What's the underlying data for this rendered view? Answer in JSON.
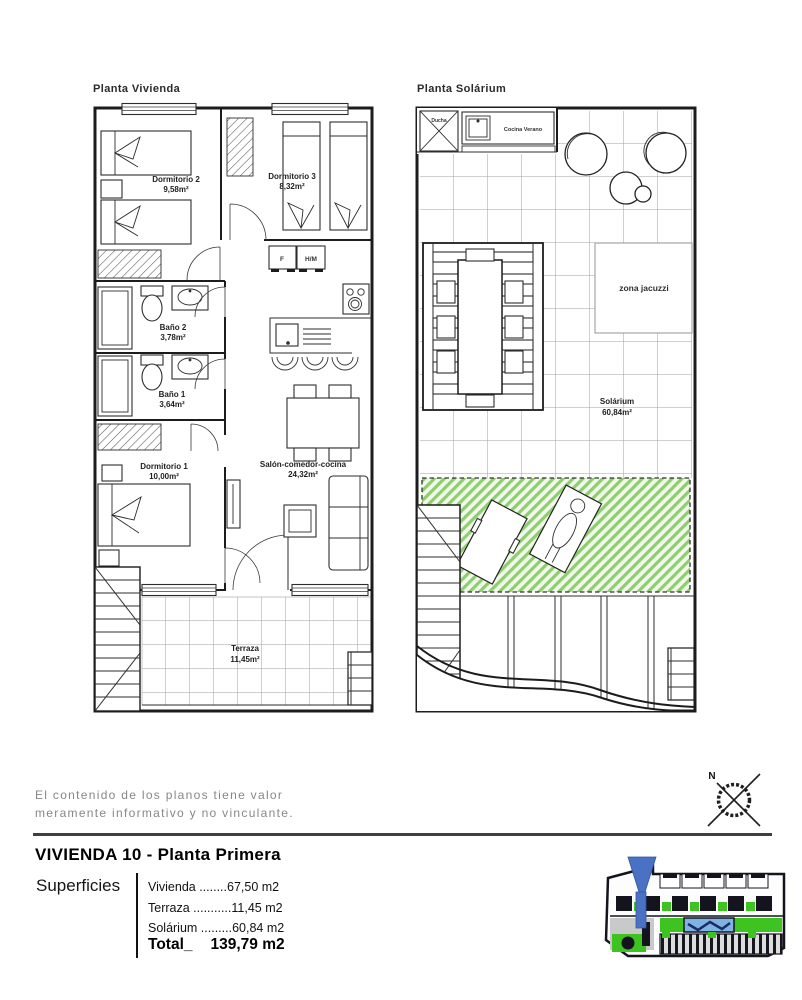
{
  "plans": {
    "vivienda": {
      "title": "Planta Vivienda",
      "dorm2": {
        "name": "Dormitorio 2",
        "area": "9,58m²"
      },
      "dorm3": {
        "name": "Dormitorio 3",
        "area": "8,32m²"
      },
      "bano2": {
        "name": "Baño 2",
        "area": "3,78m²"
      },
      "bano1": {
        "name": "Baño 1",
        "area": "3,64m²"
      },
      "dorm1": {
        "name": "Dormitorio 1",
        "area": "10,00m²"
      },
      "salon": {
        "name": "Salón-comedor-cocina",
        "area": "24,32m²"
      },
      "terraza": {
        "name": "Terraza",
        "area": "11,45m²"
      },
      "closet_f": "F",
      "closet_hm": "H/M"
    },
    "solarium": {
      "title": "Planta Solárium",
      "ducha": "Ducha",
      "cocina_verano": "Cocina Verano",
      "zona_jacuzzi": "zona jacuzzi",
      "solarium": {
        "name": "Solárium",
        "area": "60,84m²"
      }
    }
  },
  "disclaimer": {
    "line1": "El contenido de los planos tiene valor",
    "line2": "meramente informativo y no vinculante."
  },
  "title_block": {
    "title": "VIVIENDA 10 - Planta Primera",
    "superficies_label": "Superficies",
    "rows": [
      {
        "label": "Vivienda",
        "dots": " ........",
        "value": "67,50 m2"
      },
      {
        "label": "Terraza",
        "dots": " ...........",
        "value": "11,45 m2"
      },
      {
        "label": "Solárium",
        "dots": " .........",
        "value": "60,84 m2"
      }
    ],
    "total_label": "Total_",
    "total_value": "139,79 m2"
  },
  "compass": {
    "north": "N"
  },
  "colors": {
    "green_hatch": "#8fce70",
    "marker_blue": "#4a72c4",
    "pool_blue": "#7fb3e3",
    "site_green": "#3ec421",
    "line_dark": "#1c1c1c",
    "gray_text": "#878787"
  }
}
